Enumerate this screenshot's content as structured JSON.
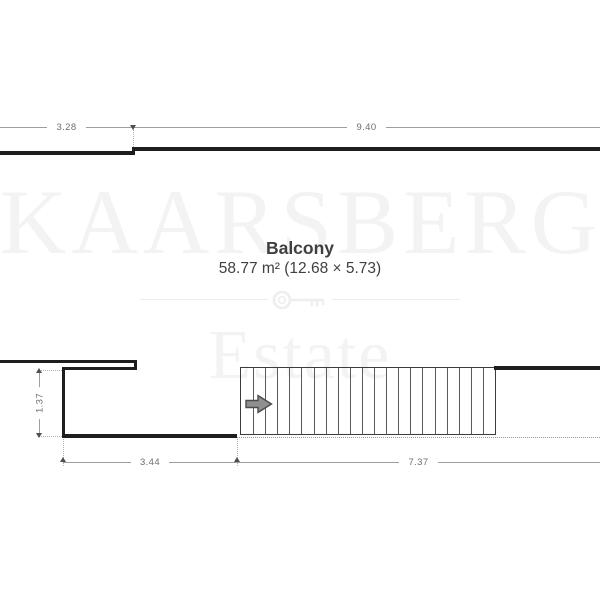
{
  "watermark": {
    "primary": "KAARSBERG",
    "secondary": "Estate",
    "icon": "key-icon"
  },
  "room": {
    "name": "Balcony",
    "area_line": "58.77 m² (12.68 × 5.73)"
  },
  "dimensions": {
    "top_left": "3.28",
    "top_right": "9.40",
    "left_vertical": "1.37",
    "bottom_left": "3.44",
    "bottom_right": "7.37"
  },
  "stairs": {
    "tread_count": 21,
    "direction": "right"
  },
  "colors": {
    "wall": "#1e1e1e",
    "stairs-outline": "#3c3c3c",
    "tread": "#5a5a5a",
    "dotted": "#9a9a9a",
    "dim-line": "#9e9e9e",
    "dim-tick": "#4f4f4f",
    "dim-text": "#6e6e6e",
    "ext-line": "#b0b0b0",
    "room-text": "#3f3f3f",
    "watermark": "#f3f3f3",
    "divider": "#ededed",
    "arrow-fill": "#8f8f8f",
    "arrow-stroke": "#4c4c4c",
    "key": "#eeeeee"
  }
}
